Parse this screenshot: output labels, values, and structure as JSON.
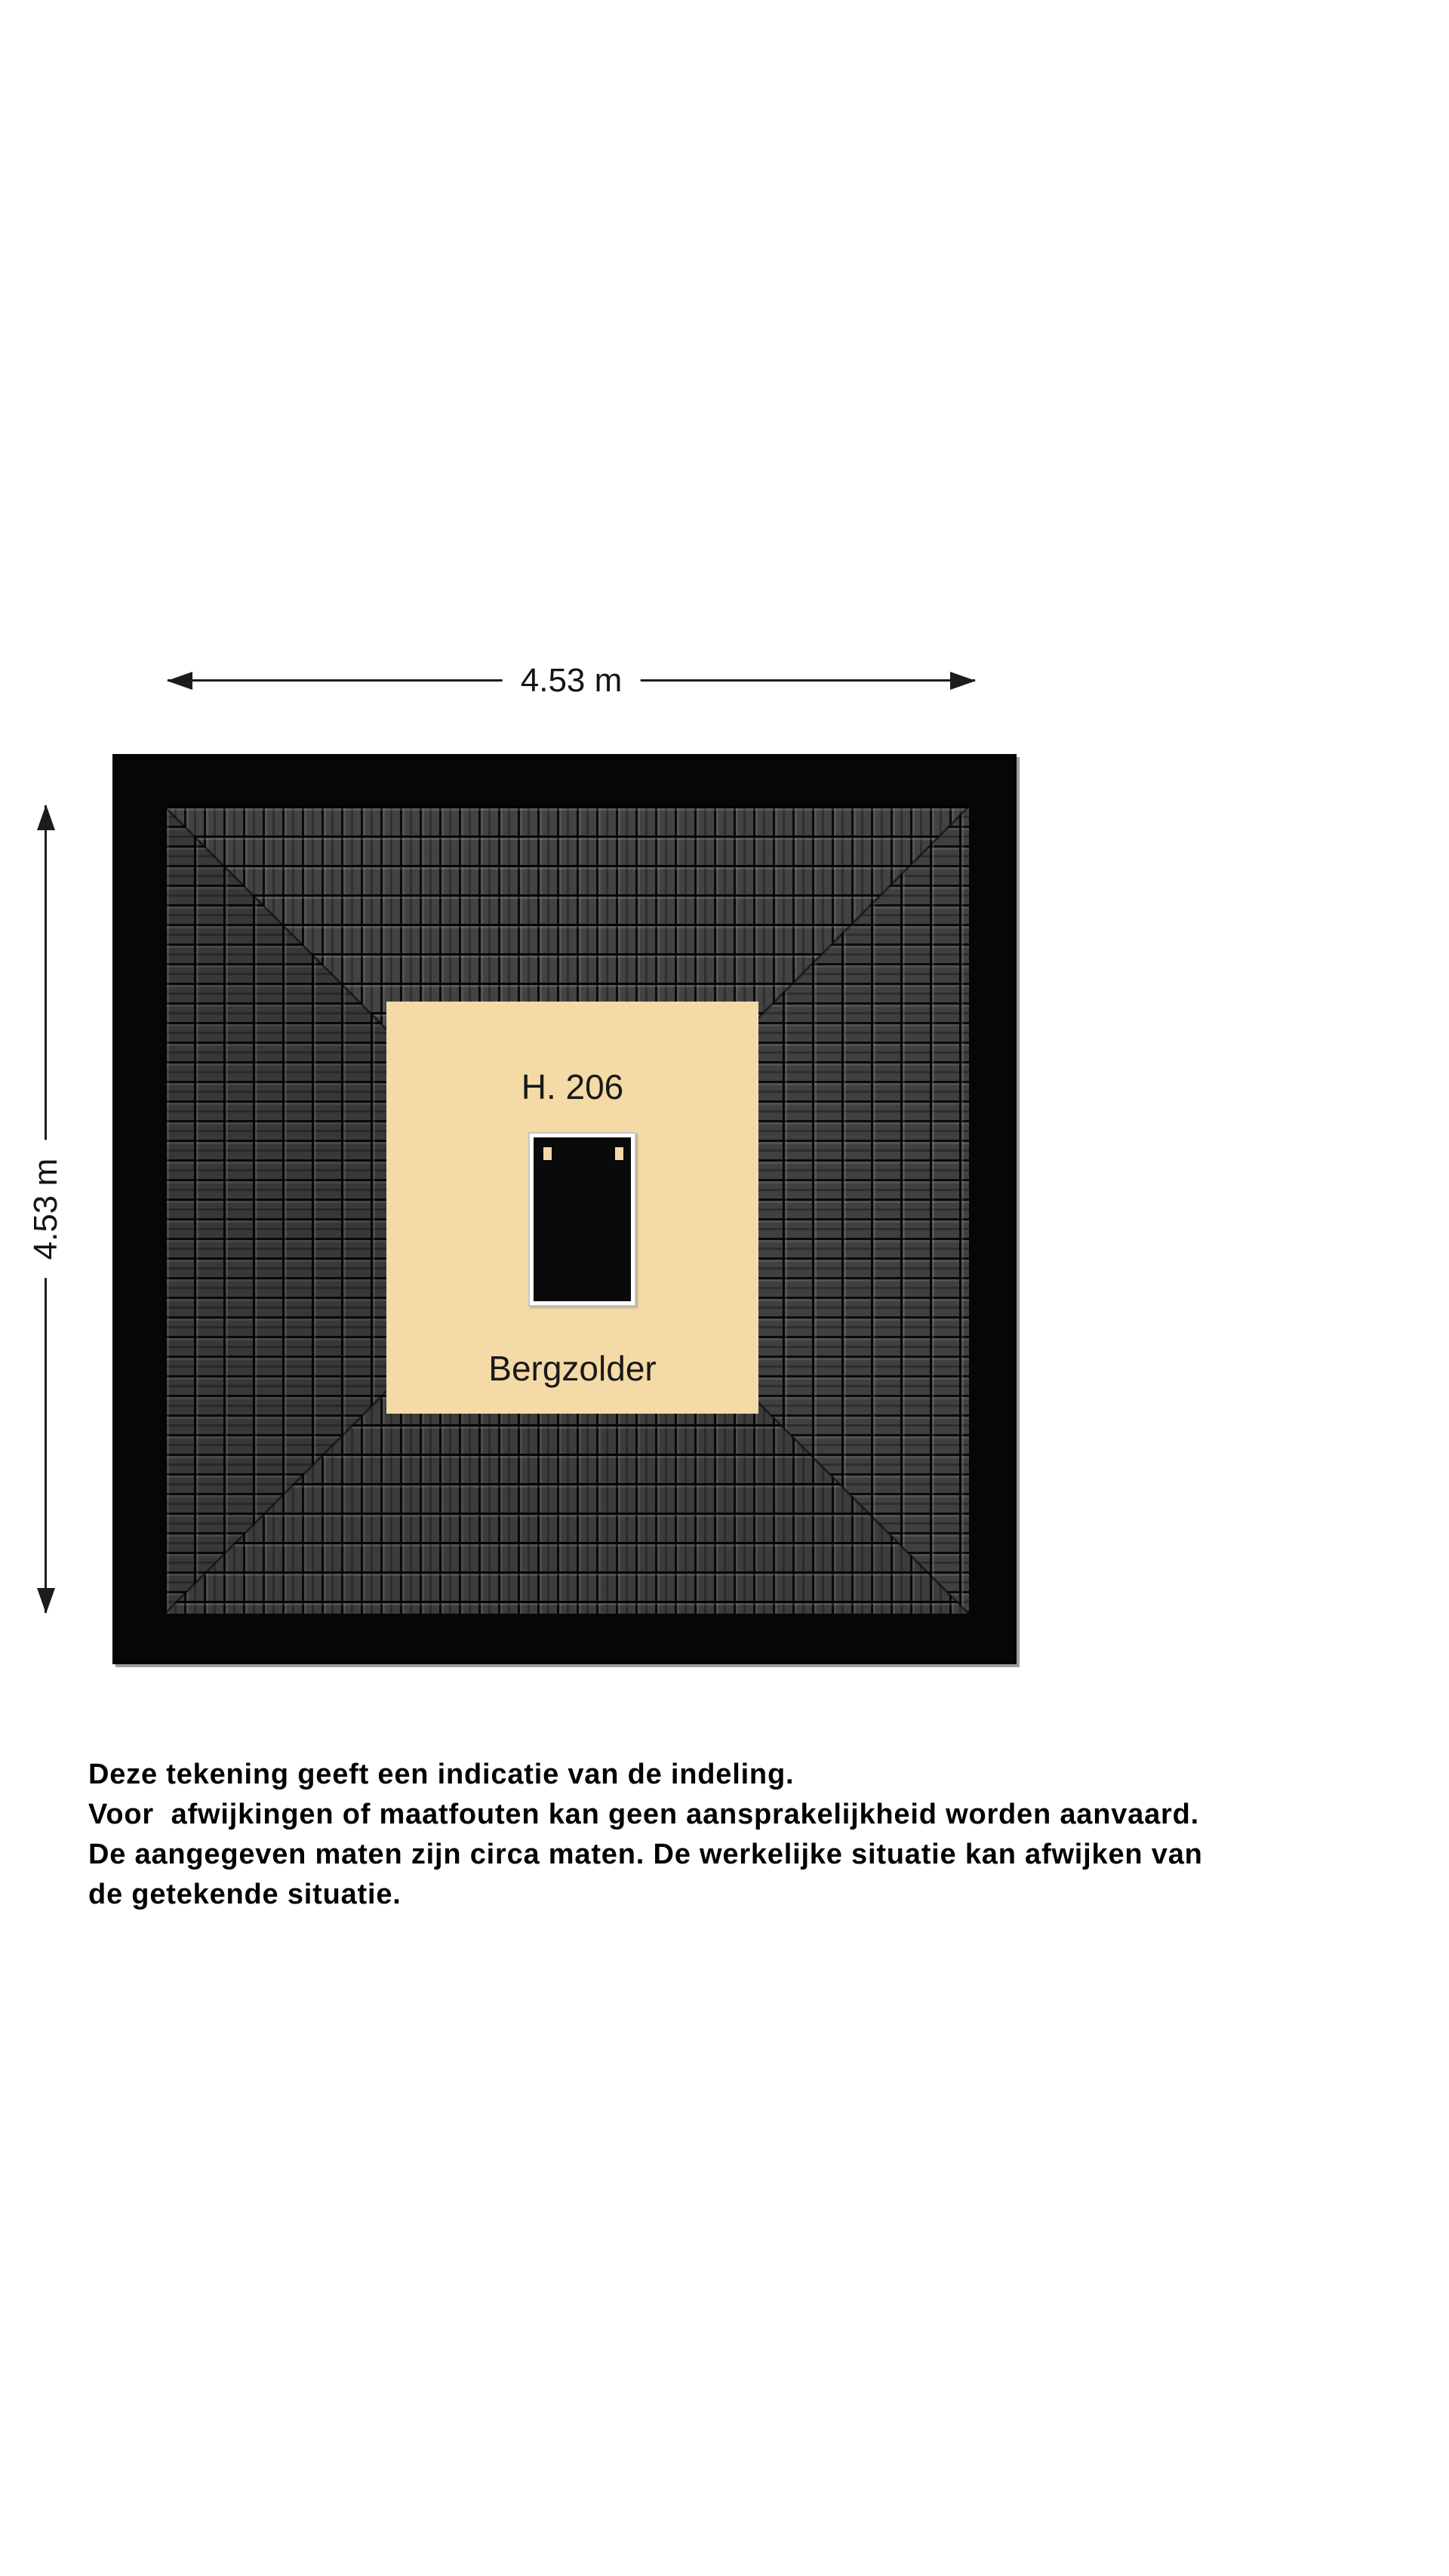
{
  "plan": {
    "room": {
      "number": "H. 206",
      "name": "Bergzolder"
    },
    "dimensions": {
      "width": "4.53 m",
      "height": "4.53 m"
    },
    "colors": {
      "floor": "#f4daa6",
      "roof_black": "#060606",
      "tile_gray": "#434343",
      "hatch_black": "#0a0a0a",
      "hatch_frame": "#ffffff",
      "edge_shadow": "#9e9e9e"
    }
  },
  "disclaimer": {
    "lines": [
      "Deze tekening geeft een indicatie van de indeling.",
      "Voor  afwijkingen of maatfouten kan geen aansprakelijkheid worden aanvaard.",
      "De aangegeven maten zijn circa maten. De werkelijke situatie kan afwijken van",
      "de getekende situatie."
    ]
  }
}
